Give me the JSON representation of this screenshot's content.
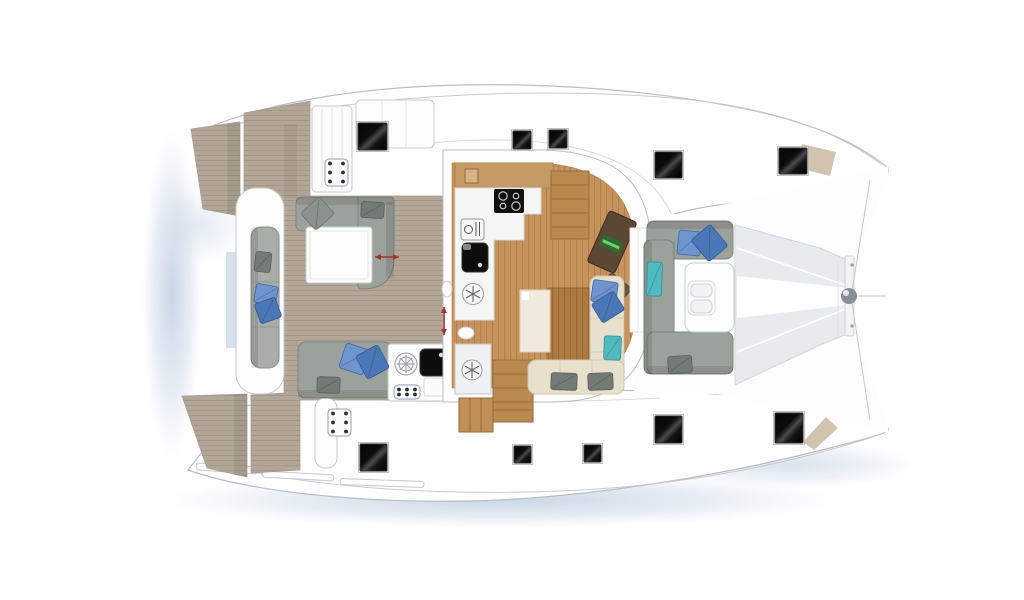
{
  "scene": {
    "label": "Catamaran deck layout plan - top view",
    "width": 1024,
    "height": 600
  },
  "palette": {
    "bg": "#ffffff",
    "hullFill": "#fefefe",
    "hullStroke": "#b9bec4",
    "shadow": "#c3d2e3",
    "water": "#cfdcea",
    "teak": "#b2a797",
    "teakLine": "#a2988a",
    "wood": "#c6935d",
    "woodLine": "#b27f48",
    "woodDark": "#aa7a42",
    "stairWood": "#b98a50",
    "stairEdge": "#966c3a",
    "cabinetWood": "#c59a63",
    "sofaGray": "#9ba19b",
    "sofaGrayDark": "#7c827c",
    "benchGray": "#a8ada7",
    "cream": "#e7e0cd",
    "creamLine": "#cfc7b0",
    "creamLight": "#efeadd",
    "pillowBlue": "#6e95cd",
    "pillowBlueDark": "#4a77b8",
    "pillowTeal": "#4fbac0",
    "pillowGray": "#747a74",
    "pillowSoftGray": "#8b918b",
    "tableWhite": "#fcfdfd",
    "tableStroke": "#c7cbd0",
    "counterWhite": "#f4f5f4",
    "hatchDark": "#0a0a0a",
    "hatchSheen": "#4a4a4a",
    "tramp": "#e8ebee",
    "trampEdge": "#d2d6da",
    "beamGray": "#8a8f94",
    "desk": "#5c4634",
    "deskEdge": "#3f2f22",
    "laptop": "#2e6b2e",
    "laptopStripe": "#6fcf6f",
    "chair": "#6d5640",
    "red": "#a8322a",
    "locker": "#cdbda6",
    "applianceStroke": "#999999",
    "black": "#0d0d0d"
  },
  "hatches": [
    {
      "x": 358,
      "y": 123,
      "w": 29,
      "h": 27
    },
    {
      "x": 513,
      "y": 131,
      "w": 18,
      "h": 18
    },
    {
      "x": 549,
      "y": 130,
      "w": 18,
      "h": 18
    },
    {
      "x": 655,
      "y": 152,
      "w": 27,
      "h": 26
    },
    {
      "x": 779,
      "y": 148,
      "w": 28,
      "h": 26
    },
    {
      "x": 360,
      "y": 444,
      "w": 27,
      "h": 27
    },
    {
      "x": 514,
      "y": 446,
      "w": 17,
      "h": 17
    },
    {
      "x": 584,
      "y": 445,
      "w": 17,
      "h": 17
    },
    {
      "x": 655,
      "y": 416,
      "w": 27,
      "h": 27
    },
    {
      "x": 775,
      "y": 413,
      "w": 28,
      "h": 30
    }
  ],
  "control_panels": [
    {
      "x": 325,
      "y": 159,
      "w": 23,
      "h": 27,
      "cols": 2,
      "rows": 3
    },
    {
      "x": 328,
      "y": 409,
      "w": 23,
      "h": 27,
      "cols": 2,
      "rows": 3
    },
    {
      "x": 394,
      "y": 385,
      "w": 26,
      "h": 14,
      "cols": 3,
      "rows": 2
    }
  ],
  "measure_arrows": [
    {
      "x1": 375,
      "y1": 257,
      "x2": 399,
      "y2": 257
    },
    {
      "x1": 444,
      "y1": 307,
      "x2": 444,
      "y2": 335
    }
  ],
  "cushions": [
    {
      "x": 305,
      "y": 202,
      "w": 25,
      "h": 23,
      "rot": -42,
      "color": "gray"
    },
    {
      "x": 361,
      "y": 202,
      "w": 23,
      "h": 16,
      "rot": 3,
      "color": "grayDark"
    },
    {
      "x": 342,
      "y": 346,
      "w": 25,
      "h": 26,
      "rot": 18,
      "color": "blue"
    },
    {
      "x": 360,
      "y": 349,
      "w": 25,
      "h": 26,
      "rot": -28,
      "color": "blueDark"
    },
    {
      "x": 317,
      "y": 377,
      "w": 23,
      "h": 16,
      "rot": 2,
      "color": "grayDark"
    },
    {
      "x": 255,
      "y": 252,
      "w": 16,
      "h": 20,
      "rot": 6,
      "color": "grayDark"
    },
    {
      "x": 255,
      "y": 285,
      "w": 22,
      "h": 19,
      "rot": 10,
      "color": "blue"
    },
    {
      "x": 257,
      "y": 300,
      "w": 22,
      "h": 21,
      "rot": -20,
      "color": "blueDark"
    },
    {
      "x": 678,
      "y": 231,
      "w": 23,
      "h": 24,
      "rot": 6,
      "color": "blue"
    },
    {
      "x": 697,
      "y": 229,
      "w": 25,
      "h": 28,
      "rot": -40,
      "color": "blueDark"
    },
    {
      "x": 647,
      "y": 262,
      "w": 15,
      "h": 34,
      "rot": 2,
      "color": "teal"
    },
    {
      "x": 668,
      "y": 356,
      "w": 24,
      "h": 17,
      "rot": -3,
      "color": "grayDark"
    },
    {
      "x": 592,
      "y": 281,
      "w": 25,
      "h": 22,
      "rot": 8,
      "color": "blue"
    },
    {
      "x": 595,
      "y": 296,
      "w": 26,
      "h": 22,
      "rot": -32,
      "color": "blueDark"
    },
    {
      "x": 604,
      "y": 336,
      "w": 17,
      "h": 24,
      "rot": 2,
      "color": "teal"
    },
    {
      "x": 551,
      "y": 373,
      "w": 26,
      "h": 17,
      "rot": 2,
      "color": "grayDark"
    },
    {
      "x": 588,
      "y": 373,
      "w": 25,
      "h": 17,
      "rot": -2,
      "color": "grayDark"
    }
  ]
}
